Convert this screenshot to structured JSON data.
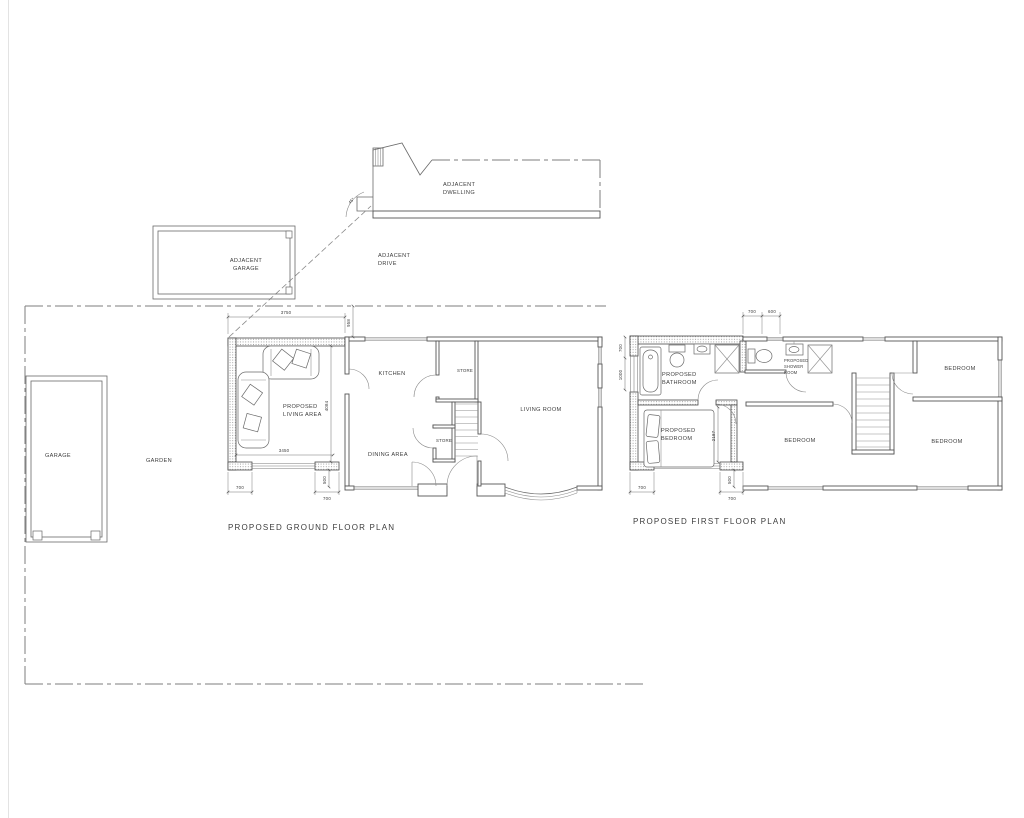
{
  "site": {
    "adjacent_dwelling": [
      "ADJACENT",
      "DWELLING"
    ],
    "adjacent_drive": [
      "ADJACENT",
      "DRIVE"
    ],
    "adjacent_garage": [
      "ADJACENT",
      "GARAGE"
    ],
    "garage": "GARAGE",
    "garden": "GARDEN",
    "sightline_angle": "45°"
  },
  "ground_floor": {
    "title": "PROPOSED GROUND FLOOR PLAN",
    "rooms": {
      "living_area": [
        "PROPOSED",
        "LIVING AREA"
      ],
      "kitchen": "KITCHEN",
      "store_top": "STORE",
      "store_mid": "STORE",
      "dining_area": "DINING AREA",
      "living_room": "LIVING ROOM"
    },
    "dims": {
      "overall_width": "3750",
      "boundary_offset": "958",
      "depth": "4084",
      "internal_width": "3450",
      "pier_left": "700",
      "pier_right": "700",
      "front_offset": "500"
    }
  },
  "first_floor": {
    "title": "PROPOSED FIRST FLOOR PLAN",
    "rooms": {
      "bathroom": [
        "PROPOSED",
        "BATHROOM"
      ],
      "bedroom_new": [
        "PROPOSED",
        "BEDROOM"
      ],
      "shower_room": [
        "PROPOSED",
        "SHOWER",
        "ROOM"
      ],
      "bedroom_rear": "BEDROOM",
      "bedroom_mid": "BEDROOM",
      "bedroom_front": "BEDROOM"
    },
    "dims": {
      "top_a": "700",
      "top_b": "600",
      "side_a": "700",
      "side_b": "1000",
      "room_depth": "2187",
      "pier_left": "700",
      "pier_right": "700",
      "front_offset": "500"
    }
  }
}
